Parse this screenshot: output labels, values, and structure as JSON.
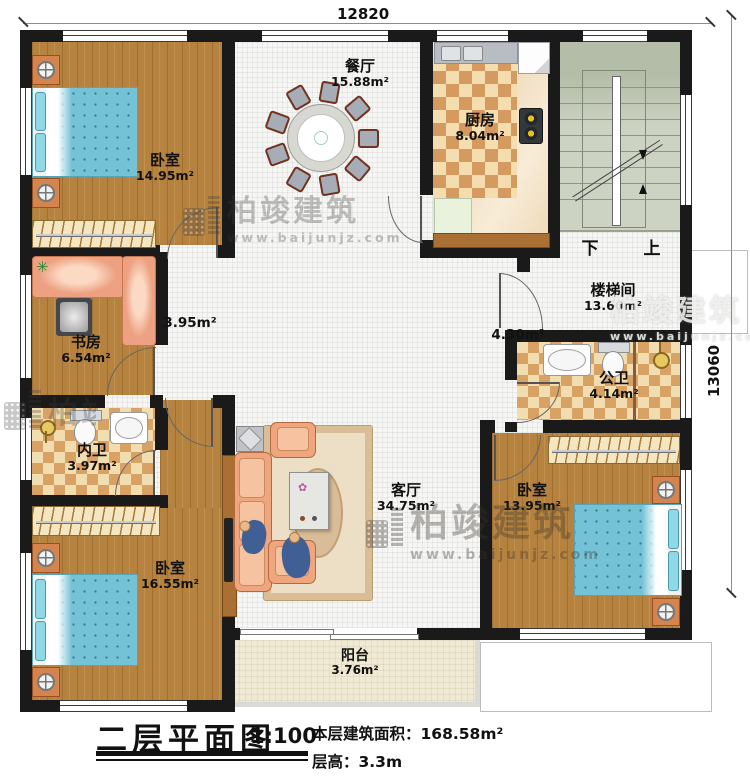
{
  "dimensions": {
    "top": "12820",
    "right": "13060"
  },
  "rooms": [
    {
      "id": "bedroom-top-left",
      "name": "卧室",
      "area": "14.95m²"
    },
    {
      "id": "dining-room",
      "name": "餐厅",
      "area": "15.88m²"
    },
    {
      "id": "kitchen",
      "name": "厨房",
      "area": "8.04m²"
    },
    {
      "id": "stairwell",
      "name": "楼梯间",
      "area": "13.60m²"
    },
    {
      "id": "hallway",
      "name": "",
      "area": "3.95m²"
    },
    {
      "id": "corridor",
      "name": "",
      "area": "4.30m²"
    },
    {
      "id": "study",
      "name": "书房",
      "area": "6.54m²"
    },
    {
      "id": "private-bath",
      "name": "内卫",
      "area": "3.97m²"
    },
    {
      "id": "public-bath",
      "name": "公卫",
      "area": "4.14m²"
    },
    {
      "id": "living-room",
      "name": "客厅",
      "area": "34.75m²"
    },
    {
      "id": "bedroom-bottom-left",
      "name": "卧室",
      "area": "16.55m²"
    },
    {
      "id": "bedroom-bottom-right",
      "name": "卧室",
      "area": "13.95m²"
    },
    {
      "id": "balcony",
      "name": "阳台",
      "area": "3.76m²"
    }
  ],
  "stairs": {
    "down_label": "下",
    "up_label": "上"
  },
  "legend": {
    "title": "二层平面图",
    "scale": "1:100",
    "floor_area": "本层建筑面积：168.58m²",
    "floor_height": "层高：3.3m"
  },
  "watermark": {
    "brand": "柏竣建筑",
    "site": "www.baijunjz.com"
  },
  "colors": {
    "wall": "#1a1a1a",
    "wood_floor": "#b5823f",
    "tile_light": "#f2ddb0",
    "tile_dark": "#d9a265",
    "stair": "#ccd3c2",
    "sofa": "#efa57d",
    "bed_blue": "#74c2d6",
    "balcony_floor": "#f0ead4"
  }
}
